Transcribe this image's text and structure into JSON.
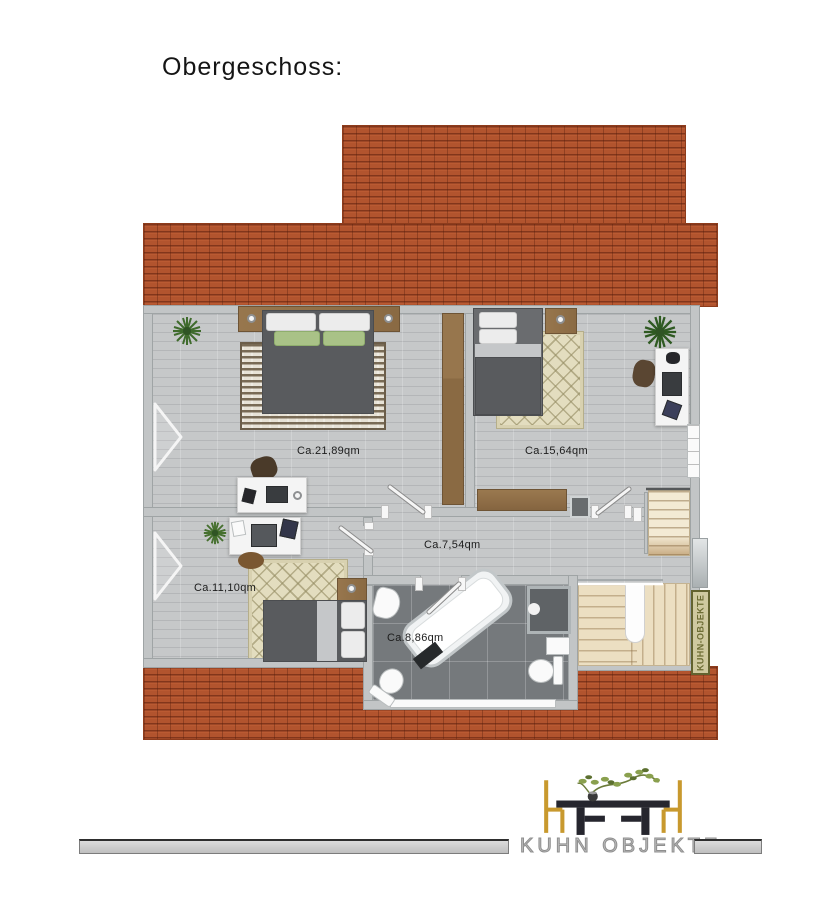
{
  "page": {
    "title": "Obergeschoss:"
  },
  "floor_plan": {
    "rooms": [
      {
        "name": "bedroom-master",
        "area_label": "Ca.21,89qm"
      },
      {
        "name": "bedroom-right",
        "area_label": "Ca.15,64qm"
      },
      {
        "name": "hallway",
        "area_label": "Ca.7,54qm"
      },
      {
        "name": "bedroom-small",
        "area_label": "Ca.11,10qm"
      },
      {
        "name": "bathroom",
        "area_label": "Ca.8,86qm"
      }
    ],
    "stair_pillar_label": "KUHN-OBJEKTE"
  },
  "footer": {
    "logo_text": "KUHN OBJEKTE"
  },
  "colors": {
    "roof": "#b2542e",
    "roof_line": "#6e2a10",
    "floor": "#c6c8c9",
    "wall": "#c2c5c6",
    "bath_tile": "#75797c",
    "stairs": "#ecdfc2",
    "wood": "#8a6a43",
    "rug_cream": "#e3ddbf",
    "bed_dark": "#595b5e",
    "pillow_green": "#a9c287",
    "logo_gold": "#c8992e",
    "logo_table": "#26262e",
    "footer_bar": "#c9c9c9"
  }
}
